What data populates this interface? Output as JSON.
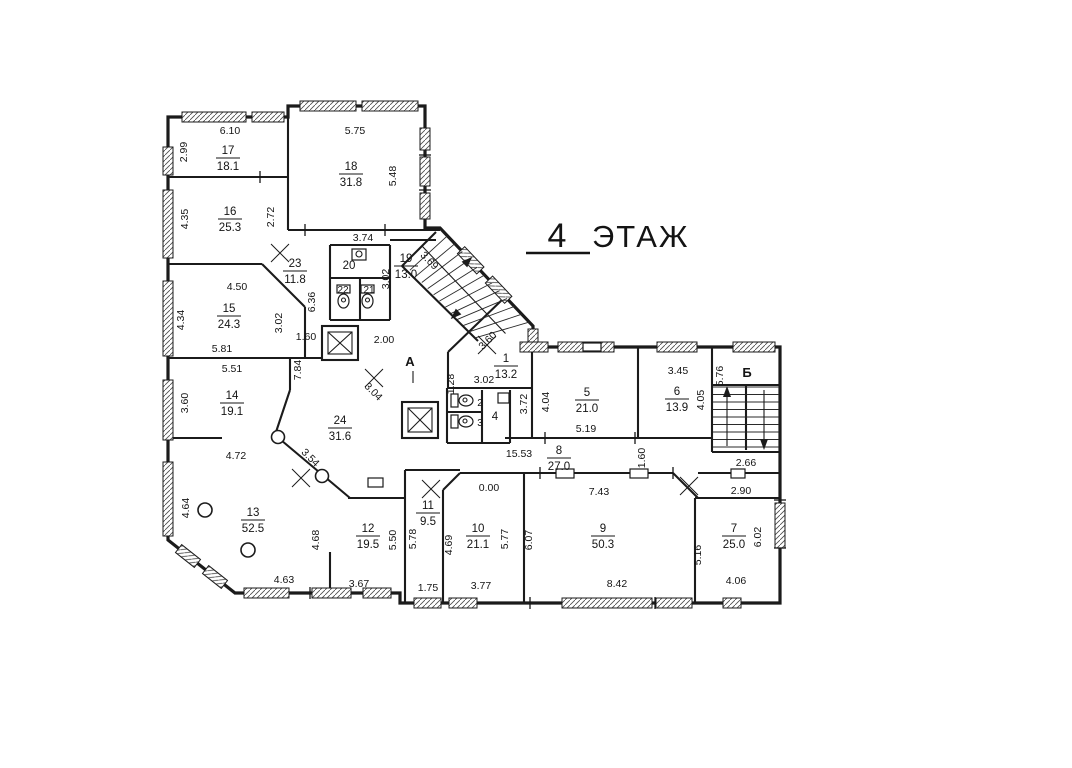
{
  "title": {
    "number": "4",
    "word": "ЭТАЖ"
  },
  "stairwells": {
    "a": "А",
    "b": "Б"
  },
  "rooms": {
    "r1": {
      "number": "1",
      "area": "13.2"
    },
    "r2": {
      "number": "2"
    },
    "r3": {
      "number": "3"
    },
    "r4": {
      "number": "4"
    },
    "r5": {
      "number": "5",
      "area": "21.0"
    },
    "r6": {
      "number": "6",
      "area": "13.9"
    },
    "r7": {
      "number": "7",
      "area": "25.0"
    },
    "r8": {
      "number": "8",
      "area": "27.0"
    },
    "r9": {
      "number": "9",
      "area": "50.3"
    },
    "r10": {
      "number": "10",
      "area": "21.1"
    },
    "r11": {
      "number": "11",
      "area": "9.5"
    },
    "r12": {
      "number": "12",
      "area": "19.5"
    },
    "r13": {
      "number": "13",
      "area": "52.5"
    },
    "r14": {
      "number": "14",
      "area": "19.1"
    },
    "r15": {
      "number": "15",
      "area": "24.3"
    },
    "r16": {
      "number": "16",
      "area": "25.3"
    },
    "r17": {
      "number": "17",
      "area": "18.1"
    },
    "r18": {
      "number": "18",
      "area": "31.8"
    },
    "r19": {
      "number": "19",
      "area": "13.0"
    },
    "r20": {
      "number": "20"
    },
    "r21": {
      "number": "21"
    },
    "r22": {
      "number": "22"
    },
    "r23": {
      "number": "23",
      "area": "11.8"
    },
    "r24": {
      "number": "24",
      "area": "31.6"
    }
  },
  "dims": {
    "v610": "6.10",
    "v299": "2.99",
    "v575": "5.75",
    "v548": "5.48",
    "v435": "4.35",
    "v272": "2.72",
    "v374": "3.74",
    "v450": "4.50",
    "v434": "4.34",
    "v302a": "3.02",
    "v636": "6.36",
    "v581": "5.81",
    "v551": "5.51",
    "v360a": "3.60",
    "v784": "7.84",
    "v160a": "1.60",
    "v200": "2.00",
    "v302b": "3.02",
    "v369": "3.69",
    "v304": "3.04",
    "v354": "3.54",
    "v360b": "3.60",
    "v128": "1.28",
    "v302c": "3.02",
    "v372": "3.72",
    "v404": "4.04",
    "v519": "5.19",
    "v345": "3.45",
    "v405": "4.05",
    "v576": "5.76",
    "v1553": "15.53",
    "v160b": "1.60",
    "v266": "2.66",
    "v290": "2.90",
    "v000": "0.00",
    "v743": "7.43",
    "v472": "4.72",
    "v464": "4.64",
    "v468": "4.68",
    "v550": "5.50",
    "v578": "5.78",
    "v469": "4.69",
    "v577": "5.77",
    "v607": "6.07",
    "v516": "5.16",
    "v602": "6.02",
    "v463": "4.63",
    "v367": "3.67",
    "v175": "1.75",
    "v377": "3.77",
    "v842": "8.42",
    "v406": "4.06"
  }
}
